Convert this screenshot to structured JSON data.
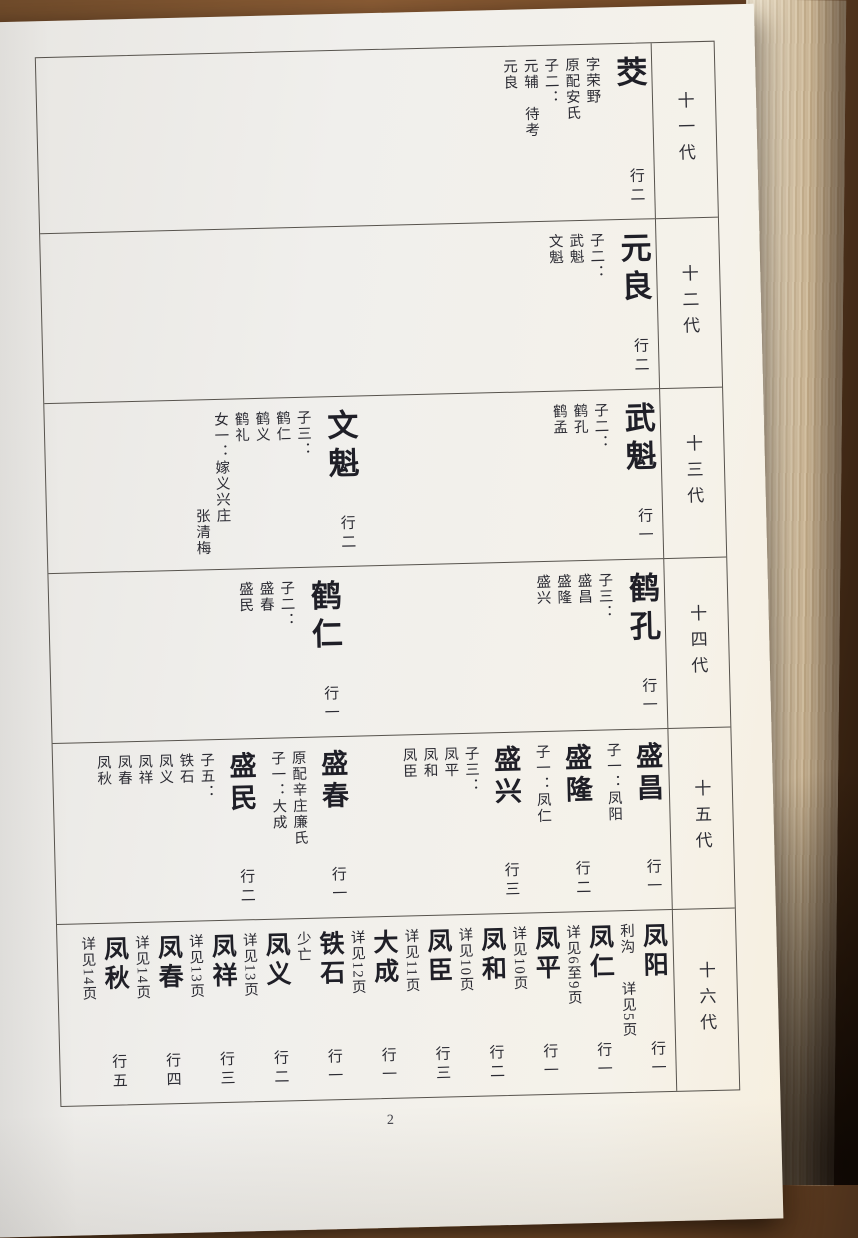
{
  "page": {
    "number": "2"
  },
  "generations": [
    {
      "label": "十一代",
      "entries": [
        {
          "name": "茭",
          "rank": "行二",
          "annotations": [
            "字荣野",
            "原配安氏"
          ],
          "children_heading": "子二：",
          "children": [
            {
              "name": "元辅",
              "note": "待考"
            },
            {
              "name": "元良"
            }
          ]
        }
      ]
    },
    {
      "label": "十二代",
      "entries": [
        {
          "name": "元良",
          "rank": "行二",
          "children_heading": "子二：",
          "children": [
            {
              "name": "武魁"
            },
            {
              "name": "文魁"
            }
          ]
        }
      ]
    },
    {
      "label": "十三代",
      "entries": [
        {
          "name": "武魁",
          "rank": "行一",
          "children_heading": "子二：",
          "children": [
            {
              "name": "鹤孔"
            },
            {
              "name": "鹤孟"
            }
          ]
        },
        {
          "name": "文魁",
          "rank": "行二",
          "children_heading": "子三：",
          "children": [
            {
              "name": "鹤仁"
            },
            {
              "name": "鹤义"
            },
            {
              "name": "鹤礼"
            }
          ],
          "extra": [
            {
              "text": "女一：嫁义兴庄"
            },
            {
              "text": "张清梅",
              "offset": true
            }
          ]
        }
      ]
    },
    {
      "label": "十四代",
      "entries": [
        {
          "name": "鹤孔",
          "rank": "行一",
          "children_heading": "子三：",
          "children": [
            {
              "name": "盛昌"
            },
            {
              "name": "盛隆"
            },
            {
              "name": "盛兴"
            }
          ]
        },
        {
          "name": "鹤仁",
          "rank": "行一",
          "children_heading": "子二：",
          "children": [
            {
              "name": "盛春"
            },
            {
              "name": "盛民"
            }
          ]
        }
      ]
    },
    {
      "label": "十五代",
      "entries": [
        {
          "name": "盛昌",
          "rank": "行一",
          "children_heading": "子一：凤阳"
        },
        {
          "name": "盛隆",
          "rank": "行二",
          "children_heading": "子一：凤仁"
        },
        {
          "name": "盛兴",
          "rank": "行三",
          "children_heading": "子三：",
          "children": [
            {
              "name": "凤平"
            },
            {
              "name": "凤和"
            },
            {
              "name": "凤臣"
            }
          ]
        },
        {
          "name": "盛春",
          "rank": "行一",
          "annotations": [
            "原配辛庄廉氏"
          ],
          "children_heading": "子一：大成"
        },
        {
          "name": "盛民",
          "rank": "行二",
          "children_heading": "子五：",
          "children": [
            {
              "name": "铁石"
            },
            {
              "name": "凤义"
            },
            {
              "name": "凤祥"
            },
            {
              "name": "凤春"
            },
            {
              "name": "凤秋"
            }
          ]
        }
      ]
    },
    {
      "label": "十六代",
      "entries": [
        {
          "name": "凤阳",
          "rank": "行一",
          "note_col": {
            "top": "利沟",
            "bottom": "详见5页"
          }
        },
        {
          "name": "凤仁",
          "rank": "行一",
          "note_col": {
            "bottom": "详见6至9页"
          }
        },
        {
          "name": "凤平",
          "rank": "行一",
          "note_col": {
            "bottom": "详见10页"
          }
        },
        {
          "name": "凤和",
          "rank": "行二",
          "note_col": {
            "bottom": "详见10页"
          }
        },
        {
          "name": "凤臣",
          "rank": "行三",
          "note_col": {
            "bottom": "详见11页"
          }
        },
        {
          "name": "大成",
          "rank": "行一",
          "note_col": {
            "bottom": "详见12页"
          }
        },
        {
          "name": "铁石",
          "rank": "行一",
          "note_col": {
            "top": "少亡"
          }
        },
        {
          "name": "凤义",
          "rank": "行二",
          "note_col": {
            "bottom": "详见13页"
          }
        },
        {
          "name": "凤祥",
          "rank": "行三",
          "note_col": {
            "bottom": "详见13页"
          }
        },
        {
          "name": "凤春",
          "rank": "行四",
          "note_col": {
            "bottom": "详见14页"
          }
        },
        {
          "name": "凤秋",
          "rank": "行五",
          "note_col": {
            "bottom": "详见14页"
          }
        }
      ]
    }
  ]
}
